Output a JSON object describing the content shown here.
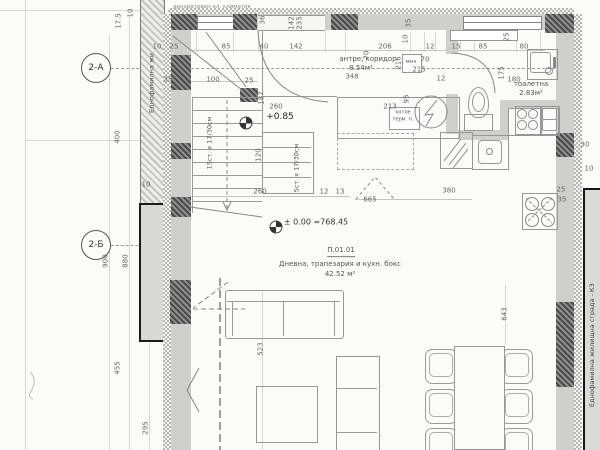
{
  "axes": {
    "a": "2-А",
    "b": "2-Б"
  },
  "strips": {
    "left": "Еднофамилна жи",
    "right": "Еднофамилна жилищна сграда - КЗ",
    "top_note": "декоративен ел. климатик"
  },
  "rooms": {
    "hallway": {
      "name": "антре, коридор",
      "area": "8.54м²"
    },
    "toilet": {
      "name": "тоалетна",
      "area": "2.83м²"
    },
    "living": {
      "number": "П.01.01",
      "name": "Дневна, трапезария и кухн. бокс",
      "area": "42.52 м²"
    }
  },
  "levels": {
    "upper": "+0.85",
    "ground": "± 0.00 =768.45"
  },
  "stairs": {
    "flight1": "15ст. х 17/30см",
    "flight2": "5ст. х 17/30см"
  },
  "equipment": {
    "boiler_line1": "котле",
    "boiler_line2": "терм. п.",
    "shaft": "мнз"
  },
  "dimensions": [
    {
      "t": "17.5",
      "x": 119,
      "y": 21,
      "r": 1
    },
    {
      "t": "10",
      "x": 131,
      "y": 13,
      "r": 1
    },
    {
      "t": "10",
      "x": 157,
      "y": 47
    },
    {
      "t": "25",
      "x": 174,
      "y": 47
    },
    {
      "t": "85",
      "x": 226,
      "y": 47
    },
    {
      "t": "40",
      "x": 264,
      "y": 47
    },
    {
      "t": "142",
      "x": 296,
      "y": 47
    },
    {
      "t": "206",
      "x": 385,
      "y": 47
    },
    {
      "t": "12",
      "x": 430,
      "y": 47
    },
    {
      "t": "15",
      "x": 456,
      "y": 47
    },
    {
      "t": "85",
      "x": 483,
      "y": 47
    },
    {
      "t": "80",
      "x": 524,
      "y": 47
    },
    {
      "t": "36",
      "x": 263,
      "y": 20,
      "r": 1
    },
    {
      "t": "142",
      "x": 292,
      "y": 23,
      "r": 1
    },
    {
      "t": "235",
      "x": 300,
      "y": 23,
      "r": 1
    },
    {
      "t": "35",
      "x": 409,
      "y": 23,
      "r": 1
    },
    {
      "t": "10",
      "x": 406,
      "y": 39,
      "r": 1
    },
    {
      "t": "70",
      "x": 367,
      "y": 55,
      "r": 1
    },
    {
      "t": "216",
      "x": 399,
      "y": 63,
      "r": 1
    },
    {
      "t": "70",
      "x": 425,
      "y": 60
    },
    {
      "t": "215",
      "x": 419,
      "y": 70
    },
    {
      "t": "12",
      "x": 441,
      "y": 79
    },
    {
      "t": "25",
      "x": 507,
      "y": 37,
      "r": 1
    },
    {
      "t": "175",
      "x": 502,
      "y": 73,
      "r": 1
    },
    {
      "t": "180",
      "x": 514,
      "y": 80
    },
    {
      "t": "35",
      "x": 168,
      "y": 80
    },
    {
      "t": "100",
      "x": 213,
      "y": 80
    },
    {
      "t": "25",
      "x": 249,
      "y": 81
    },
    {
      "t": "187",
      "x": 262,
      "y": 98,
      "r": 1
    },
    {
      "t": "260",
      "x": 276,
      "y": 107
    },
    {
      "t": "348",
      "x": 352,
      "y": 77
    },
    {
      "t": "213",
      "x": 390,
      "y": 107
    },
    {
      "t": "95",
      "x": 407,
      "y": 99,
      "r": 1
    },
    {
      "t": "120",
      "x": 259,
      "y": 155,
      "r": 1
    },
    {
      "t": "260",
      "x": 260,
      "y": 192
    },
    {
      "t": "12",
      "x": 324,
      "y": 192
    },
    {
      "t": "13",
      "x": 340,
      "y": 192
    },
    {
      "t": "380",
      "x": 449,
      "y": 191
    },
    {
      "t": "665",
      "x": 370,
      "y": 200
    },
    {
      "t": "400",
      "x": 118,
      "y": 137,
      "r": 1
    },
    {
      "t": "10",
      "x": 146,
      "y": 185
    },
    {
      "t": "900",
      "x": 106,
      "y": 261,
      "r": 1
    },
    {
      "t": "880",
      "x": 126,
      "y": 261,
      "r": 1
    },
    {
      "t": "455",
      "x": 118,
      "y": 368,
      "r": 1
    },
    {
      "t": "295",
      "x": 146,
      "y": 428,
      "r": 1
    },
    {
      "t": "523",
      "x": 261,
      "y": 349,
      "r": 1
    },
    {
      "t": "643",
      "x": 505,
      "y": 314,
      "r": 1
    },
    {
      "t": "30",
      "x": 585,
      "y": 145
    },
    {
      "t": "10",
      "x": 589,
      "y": 169
    },
    {
      "t": "25",
      "x": 561,
      "y": 190
    },
    {
      "t": "35",
      "x": 562,
      "y": 200
    }
  ]
}
